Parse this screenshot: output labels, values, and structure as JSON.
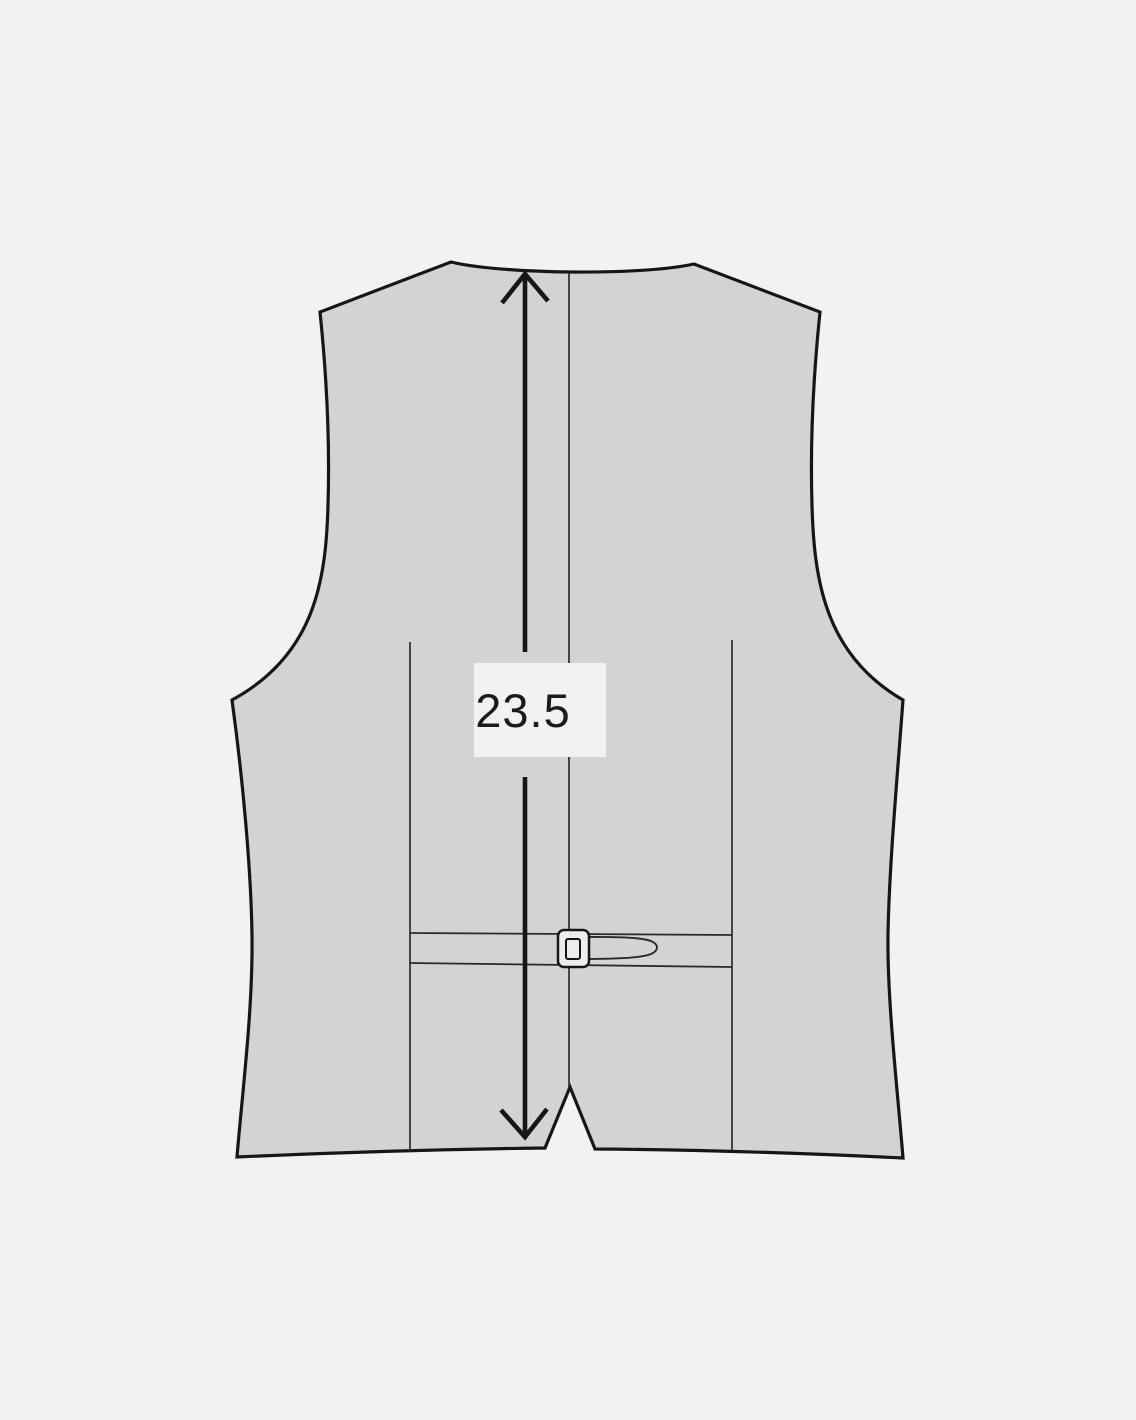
{
  "measurement": {
    "value": "23.5"
  },
  "colors": {
    "background": "#f2f2f1",
    "garment": "#d3d3d3",
    "outline": "#161616",
    "seam": "#2a2a2a",
    "buckle": "#ededed",
    "text": "#1b1b1b"
  }
}
